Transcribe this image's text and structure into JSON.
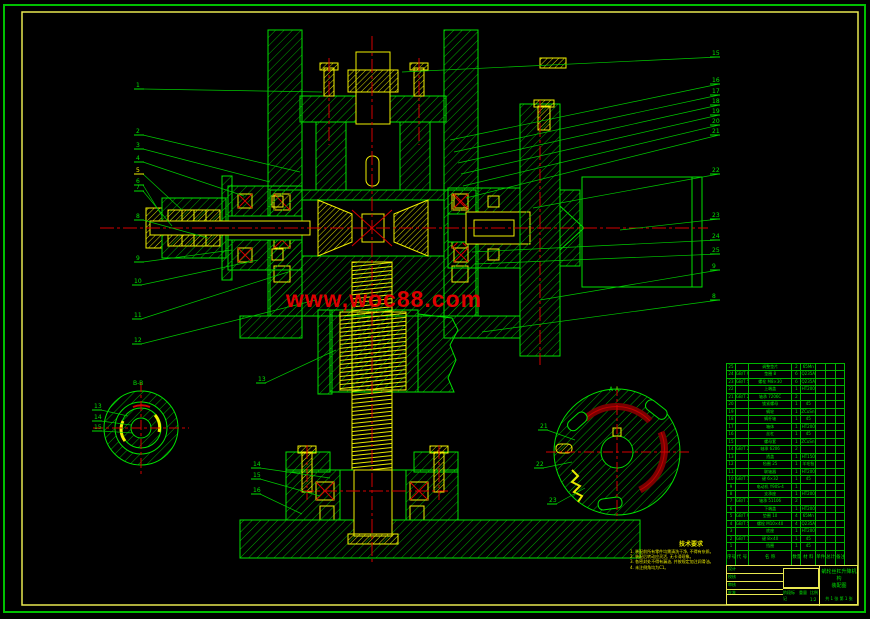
{
  "watermark": {
    "text": "www,woc88.com",
    "color": "#dd0000"
  },
  "frame": {
    "outer_color": "#00c000",
    "inner_color": "#e8e850"
  },
  "views": {
    "left_section_label": "B-B",
    "right_section_label": "A-A"
  },
  "colors": {
    "green": "#00e100",
    "hatch_green": "#00a800",
    "yellow": "#f0f000",
    "red": "#d40000",
    "dark_red": "#7a0000"
  },
  "notes": {
    "title": "技术要求",
    "lines": [
      "1. 装配前所有零件均需清洗干净, 不得有杂质。",
      "2. 装配后转动应灵活, 无卡滞现象。",
      "3. 各密封处不得有漏油, 并按规定加注润滑油。",
      "4. 未注倒角均为C1。"
    ]
  },
  "bom": {
    "headers": [
      "序号",
      "代 号",
      "名  称",
      "数量",
      "材 料",
      "单件",
      "总计",
      "备注"
    ],
    "rows": [
      [
        "25",
        "",
        "调整垫片",
        "2",
        "65Mn",
        "",
        "",
        ""
      ],
      [
        "24",
        "GB/T 97.1",
        "垫圈 8",
        "6",
        "Q235A",
        "",
        "",
        ""
      ],
      [
        "23",
        "GB/T 5782",
        "螺栓 M8×30",
        "6",
        "Q235A",
        "",
        "",
        ""
      ],
      [
        "22",
        "",
        "上端盖",
        "1",
        "HT200",
        "",
        "",
        ""
      ],
      [
        "21",
        "GB/T 292",
        "轴承 7206C",
        "2",
        "",
        "",
        "",
        ""
      ],
      [
        "20",
        "",
        "锁紧螺母",
        "1",
        "45",
        "",
        "",
        ""
      ],
      [
        "19",
        "",
        "蜗轮",
        "1",
        "ZCuSn10P1",
        "",
        "",
        ""
      ],
      [
        "18",
        "",
        "蜗杆轴",
        "1",
        "45",
        "",
        "",
        ""
      ],
      [
        "17",
        "",
        "箱体",
        "1",
        "HT200",
        "",
        "",
        ""
      ],
      [
        "16",
        "",
        "丝杠",
        "1",
        "45",
        "",
        "",
        ""
      ],
      [
        "15",
        "",
        "螺母套",
        "1",
        "ZCuSn10P1",
        "",
        "",
        ""
      ],
      [
        "14",
        "GB/T 276",
        "轴承 6206",
        "2",
        "",
        "",
        "",
        ""
      ],
      [
        "13",
        "",
        "透盖",
        "1",
        "HT150",
        "",
        "",
        ""
      ],
      [
        "12",
        "",
        "毡圈 25",
        "1",
        "羊毛毡",
        "",
        "",
        ""
      ],
      [
        "11",
        "",
        "联轴器",
        "1",
        "HT200",
        "",
        "",
        ""
      ],
      [
        "10",
        "GB/T 1096",
        "键 6×32",
        "1",
        "45",
        "",
        "",
        ""
      ],
      [
        "9",
        "",
        "电动机 Y90S-4",
        "1",
        "",
        "",
        "",
        ""
      ],
      [
        "8",
        "",
        "支承座",
        "1",
        "HT200",
        "",
        "",
        ""
      ],
      [
        "7",
        "GB/T 301",
        "轴承 51106",
        "2",
        "",
        "",
        "",
        ""
      ],
      [
        "6",
        "",
        "下端盖",
        "1",
        "HT200",
        "",
        "",
        ""
      ],
      [
        "5",
        "GB/T 93",
        "垫圈 10",
        "4",
        "65Mn",
        "",
        "",
        ""
      ],
      [
        "4",
        "GB/T 5783",
        "螺栓 M10×40",
        "4",
        "Q235A",
        "",
        "",
        ""
      ],
      [
        "3",
        "",
        "底座",
        "1",
        "HT200",
        "",
        "",
        ""
      ],
      [
        "2",
        "GB/T 1096",
        "键 8×40",
        "1",
        "45",
        "",
        "",
        ""
      ],
      [
        "1",
        "",
        "挡圈",
        "1",
        "45",
        "",
        "",
        ""
      ]
    ]
  },
  "title_block": {
    "sign_rows": [
      "设计",
      "校核",
      "审核",
      "批准"
    ],
    "stage_label": "阶段标记",
    "weight_label": "重量",
    "scale_label": "比例",
    "scale": "1:2",
    "product": "蜗轮丝杠升降机构",
    "doc_type": "装配图",
    "sheet_info": "共 1 张 第 1 张"
  },
  "balloons": [
    {
      "n": "1",
      "x": 136,
      "y": 87,
      "tx": 322,
      "ty": 92,
      "c": "#00e100"
    },
    {
      "n": "2",
      "x": 136,
      "y": 133,
      "tx": 300,
      "ty": 172,
      "c": "#00e100"
    },
    {
      "n": "3",
      "x": 136,
      "y": 147,
      "tx": 270,
      "ty": 182,
      "c": "#00e100"
    },
    {
      "n": "4",
      "x": 136,
      "y": 160,
      "tx": 244,
      "ty": 196,
      "c": "#00e100"
    },
    {
      "n": "5",
      "x": 136,
      "y": 172,
      "tx": 182,
      "ty": 210,
      "c": "#f0f000"
    },
    {
      "n": "6",
      "x": 136,
      "y": 183,
      "tx": 162,
      "ty": 216,
      "c": "#00e100"
    },
    {
      "n": "7",
      "x": 136,
      "y": 189,
      "tx": 172,
      "ty": 226,
      "c": "#00e100"
    },
    {
      "n": "8",
      "x": 136,
      "y": 218,
      "tx": 208,
      "ty": 238,
      "c": "#00e100"
    },
    {
      "n": "9",
      "x": 136,
      "y": 260,
      "tx": 232,
      "ty": 250,
      "c": "#00e100"
    },
    {
      "n": "10",
      "x": 134,
      "y": 283,
      "tx": 258,
      "ty": 260,
      "c": "#00e100"
    },
    {
      "n": "11",
      "x": 134,
      "y": 317,
      "tx": 288,
      "ty": 272,
      "c": "#00e100"
    },
    {
      "n": "12",
      "x": 134,
      "y": 342,
      "tx": 316,
      "ty": 300,
      "c": "#00e100"
    },
    {
      "n": "13",
      "x": 258,
      "y": 381,
      "tx": 336,
      "ty": 350,
      "c": "#00e100"
    },
    {
      "n": "14",
      "x": 253,
      "y": 466,
      "tx": 330,
      "ty": 478,
      "c": "#00e100"
    },
    {
      "n": "15",
      "x": 253,
      "y": 477,
      "tx": 320,
      "ty": 496,
      "c": "#00e100"
    },
    {
      "n": "16",
      "x": 253,
      "y": 492,
      "tx": 302,
      "ty": 514,
      "c": "#00e100"
    },
    {
      "n": "13",
      "x": 94,
      "y": 408,
      "tx": 128,
      "ty": 416,
      "c": "#00e100"
    },
    {
      "n": "14",
      "x": 94,
      "y": 419,
      "tx": 131,
      "ty": 425,
      "c": "#00e100"
    },
    {
      "n": "15",
      "x": 94,
      "y": 429,
      "tx": 133,
      "ty": 433,
      "c": "#00e100"
    },
    {
      "n": "15",
      "x": 712,
      "y": 55,
      "tx": 402,
      "ty": 72,
      "c": "#00e100"
    },
    {
      "n": "16",
      "x": 712,
      "y": 82,
      "tx": 450,
      "ty": 140,
      "c": "#00e100"
    },
    {
      "n": "17",
      "x": 712,
      "y": 93,
      "tx": 454,
      "ty": 152,
      "c": "#00e100"
    },
    {
      "n": "18",
      "x": 712,
      "y": 103,
      "tx": 458,
      "ty": 163,
      "c": "#00e100"
    },
    {
      "n": "19",
      "x": 712,
      "y": 113,
      "tx": 461,
      "ty": 174,
      "c": "#00e100"
    },
    {
      "n": "20",
      "x": 712,
      "y": 123,
      "tx": 463,
      "ty": 186,
      "c": "#00e100"
    },
    {
      "n": "21",
      "x": 712,
      "y": 133,
      "tx": 466,
      "ty": 198,
      "c": "#00e100"
    },
    {
      "n": "22",
      "x": 712,
      "y": 172,
      "tx": 533,
      "ty": 208,
      "c": "#00e100"
    },
    {
      "n": "23",
      "x": 712,
      "y": 217,
      "tx": 620,
      "ty": 230,
      "c": "#00e100"
    },
    {
      "n": "24",
      "x": 712,
      "y": 238,
      "tx": 472,
      "ty": 252,
      "c": "#00e100"
    },
    {
      "n": "25",
      "x": 712,
      "y": 252,
      "tx": 475,
      "ty": 264,
      "c": "#00e100"
    },
    {
      "n": "9",
      "x": 712,
      "y": 268,
      "tx": 540,
      "ty": 300,
      "c": "#00e100"
    },
    {
      "n": "8",
      "x": 712,
      "y": 298,
      "tx": 482,
      "ty": 332,
      "c": "#00e100"
    },
    {
      "n": "21",
      "x": 540,
      "y": 428,
      "tx": 575,
      "ty": 440,
      "c": "#00e100"
    },
    {
      "n": "22",
      "x": 536,
      "y": 466,
      "tx": 572,
      "ty": 462,
      "c": "#00e100"
    },
    {
      "n": "23",
      "x": 549,
      "y": 502,
      "tx": 585,
      "ty": 488,
      "c": "#00e100"
    }
  ]
}
